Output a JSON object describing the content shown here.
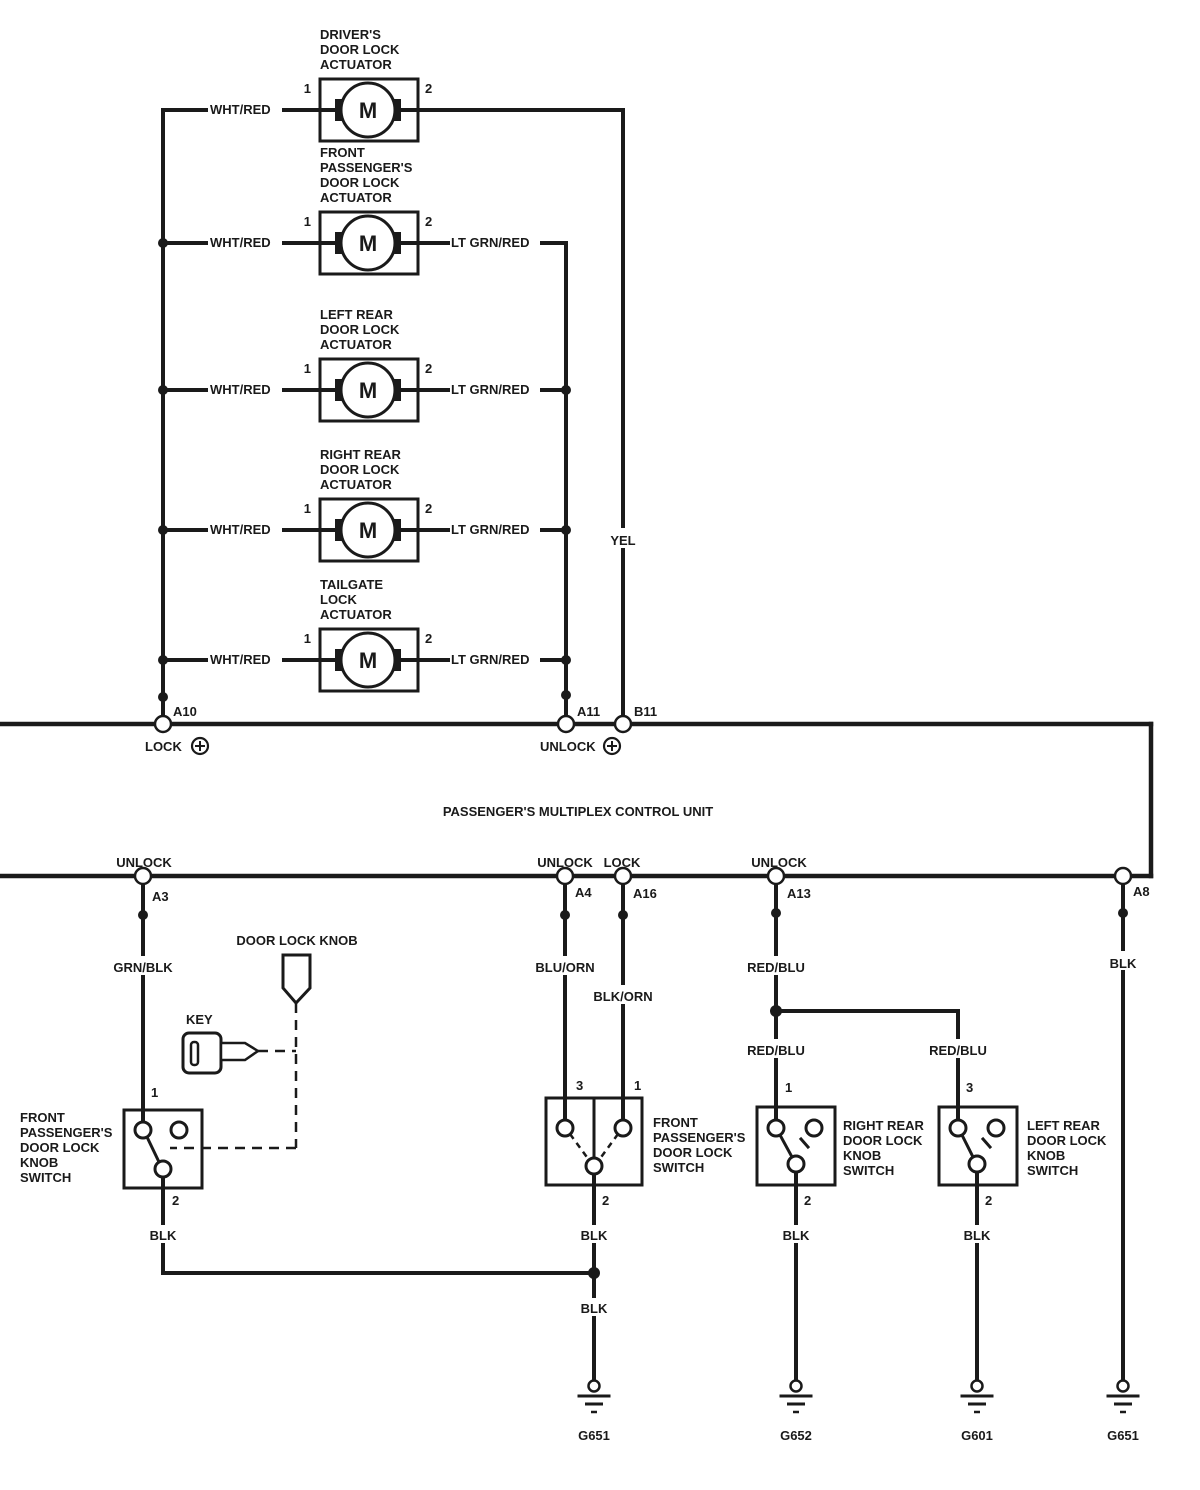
{
  "unit": {
    "title": "PASSENGER'S MULTIPLEX CONTROL UNIT"
  },
  "motor": {
    "symbol": "M"
  },
  "actuators": [
    {
      "label": [
        "DRIVER'S",
        "DOOR LOCK",
        "ACTUATOR"
      ],
      "pin1": "1",
      "pin2": "2",
      "wire_left": "WHT/RED"
    },
    {
      "label": [
        "FRONT",
        "PASSENGER'S",
        "DOOR LOCK",
        "ACTUATOR"
      ],
      "pin1": "1",
      "pin2": "2",
      "wire_left": "WHT/RED",
      "wire_right": "LT GRN/RED"
    },
    {
      "label": [
        "LEFT REAR",
        "DOOR LOCK",
        "ACTUATOR"
      ],
      "pin1": "1",
      "pin2": "2",
      "wire_left": "WHT/RED",
      "wire_right": "LT GRN/RED"
    },
    {
      "label": [
        "RIGHT REAR",
        "DOOR LOCK",
        "ACTUATOR"
      ],
      "pin1": "1",
      "pin2": "2",
      "wire_left": "WHT/RED",
      "wire_right": "LT GRN/RED"
    },
    {
      "label": [
        "TAILGATE",
        "LOCK",
        "ACTUATOR"
      ],
      "pin1": "1",
      "pin2": "2",
      "wire_left": "WHT/RED",
      "wire_right": "LT GRN/RED"
    }
  ],
  "top_connectors": {
    "a10": {
      "pin": "A10",
      "function": "LOCK"
    },
    "a11": {
      "pin": "A11",
      "function": "UNLOCK"
    },
    "b11": {
      "pin": "B11"
    }
  },
  "bottom_connectors": {
    "a3": {
      "pin": "A3",
      "function": "UNLOCK"
    },
    "a4": {
      "pin": "A4",
      "function": "UNLOCK"
    },
    "a16": {
      "pin": "A16",
      "function": "LOCK"
    },
    "a13": {
      "pin": "A13",
      "function": "UNLOCK"
    },
    "a8": {
      "pin": "A8"
    }
  },
  "wire_labels": {
    "yel": "YEL",
    "grn_blk": "GRN/BLK",
    "blu_orn": "BLU/ORN",
    "blk_orn": "BLK/ORN",
    "red_blu": "RED/BLU",
    "blk": "BLK"
  },
  "switches": {
    "fp_knob": {
      "label": [
        "FRONT",
        "PASSENGER'S",
        "DOOR LOCK",
        "KNOB",
        "SWITCH"
      ],
      "pin_top": "1",
      "pin_bottom": "2"
    },
    "fp_lock": {
      "label": [
        "FRONT",
        "PASSENGER'S",
        "DOOR LOCK",
        "SWITCH"
      ],
      "pin_top_left": "3",
      "pin_top_right": "1",
      "pin_bottom": "2"
    },
    "rr_knob": {
      "label": [
        "RIGHT REAR",
        "DOOR LOCK",
        "KNOB",
        "SWITCH"
      ],
      "pin_top": "1",
      "pin_bottom": "2"
    },
    "lr_knob": {
      "label": [
        "LEFT REAR",
        "DOOR LOCK",
        "KNOB",
        "SWITCH"
      ],
      "pin_top": "3",
      "pin_bottom": "2"
    }
  },
  "key": {
    "label": "KEY"
  },
  "door_lock_knob": {
    "label": "DOOR LOCK KNOB"
  },
  "grounds": [
    "G651",
    "G652",
    "G601",
    "G651"
  ]
}
